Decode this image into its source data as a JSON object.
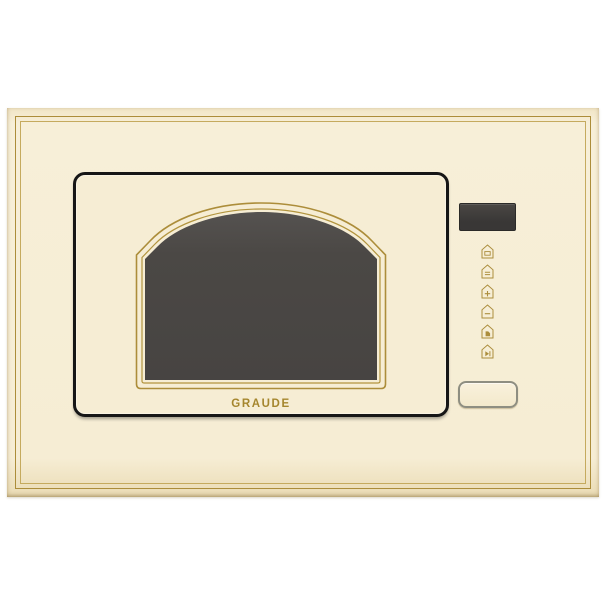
{
  "brand": {
    "logo_text": "GRAUDE"
  },
  "appliance": {
    "kind": "built-in microwave oven front panel",
    "colors": {
      "body_cream": "#f6edd4",
      "trim_gold": "#ac8d3a",
      "door_outline_black": "#161616",
      "window_glass_dark": "#4b4845",
      "display_dark": "#3b3938",
      "logo_gold": "#a5862e",
      "open_button_border": "#8e8e81"
    }
  },
  "display": {
    "value": "",
    "state": "off"
  },
  "controls": {
    "buttons": [
      {
        "id": "microwave-power-button",
        "icon": "microwave-icon"
      },
      {
        "id": "grill-button",
        "icon": "grill-icon"
      },
      {
        "id": "increase-button",
        "icon": "plus-icon"
      },
      {
        "id": "decrease-button",
        "icon": "minus-icon"
      },
      {
        "id": "timer-button",
        "icon": "clock-icon"
      },
      {
        "id": "start-button",
        "icon": "play-icon"
      }
    ],
    "open_button_label": ""
  }
}
